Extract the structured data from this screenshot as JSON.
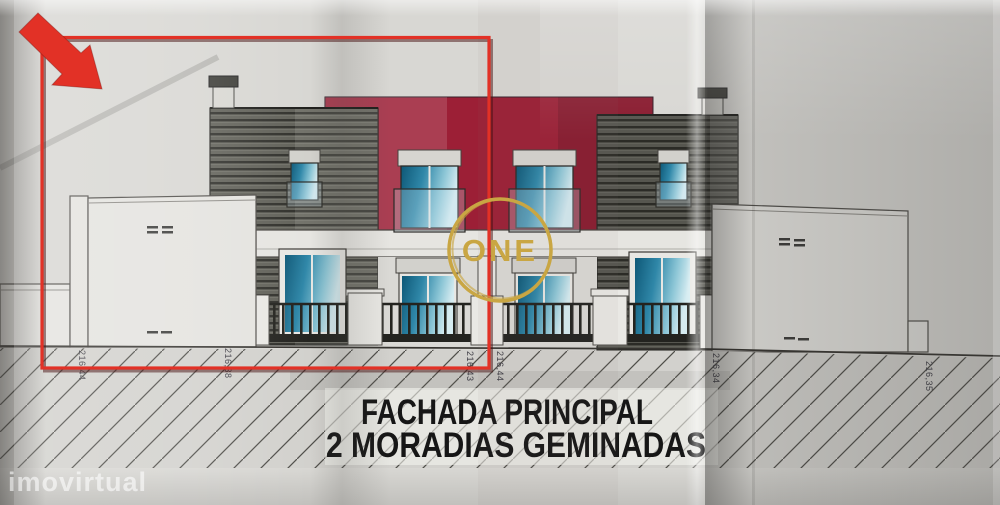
{
  "caption": {
    "line1": "FACHADA PRINCIPAL",
    "line2": "2 MORADIAS GEMINADAS"
  },
  "logo": {
    "text": "ONE"
  },
  "watermark": {
    "text": "imovirtual"
  },
  "dimension_labels": [
    "216,44",
    "216,38",
    "216,43",
    "216,44",
    "216,34",
    "216,35"
  ],
  "colors": {
    "accent_red": "#e23126",
    "maroon": "#9c1f36",
    "gold": "#c9a643",
    "glass_blue": "#2f87a8",
    "cladding_gray": "#4c4c45",
    "paper": "#d8d7d3"
  }
}
